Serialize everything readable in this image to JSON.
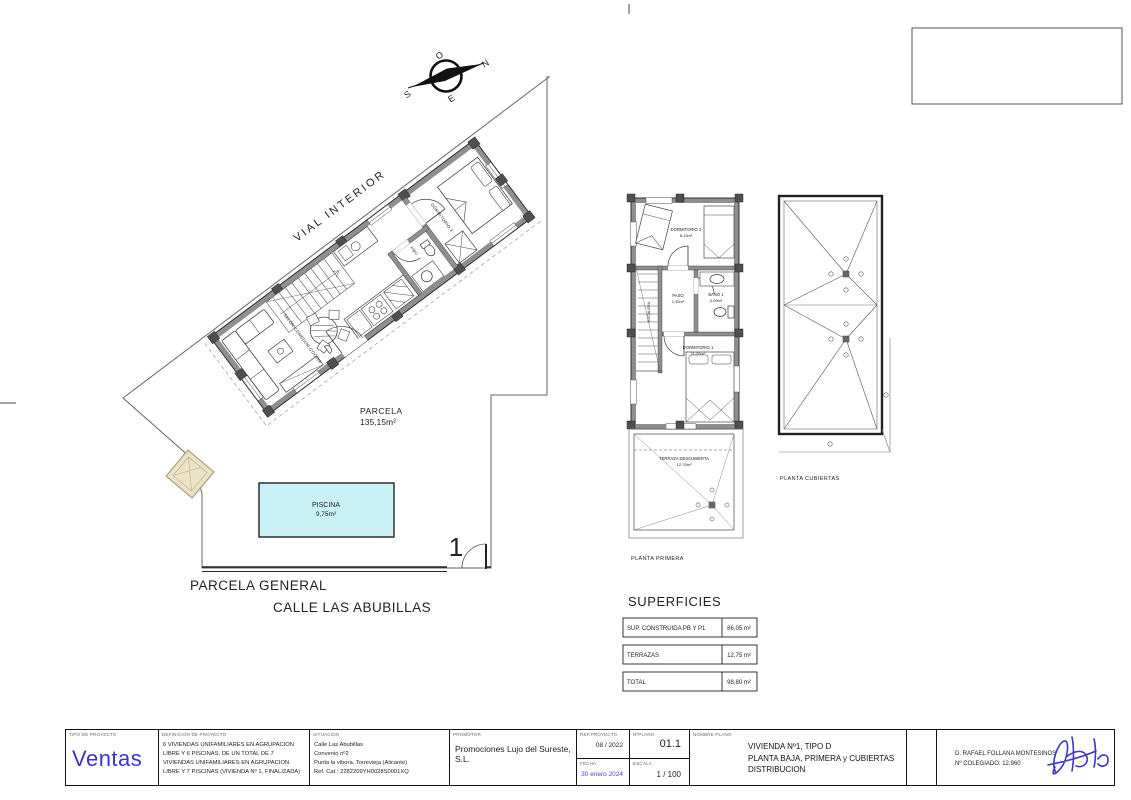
{
  "compass": {
    "n": "N",
    "s": "S",
    "e": "E",
    "o": "O"
  },
  "site": {
    "vial_interior": "VIAL INTERIOR",
    "parcela_label": "PARCELA",
    "parcela_area": "135,15m²",
    "piscina_label": "PISCINA",
    "piscina_area": "9,75m²",
    "parcela_general": "PARCELA GENERAL",
    "street": "CALLE LAS ABUBILLAS",
    "gate_number": "1"
  },
  "ground_floor": {
    "salon": "SALON-COMEDOR-COCINA",
    "dormitorio": "DORMITORIO 3",
    "aseo": "ASEO"
  },
  "first_floor": {
    "caption": "PLANTA PRIMERA",
    "dormitorio2": "DORMITORIO 2",
    "dormitorio2_area": "8,13m²",
    "escalera": "ESCALERA",
    "paso": "PASO",
    "paso_area": "1,92m²",
    "bano": "BAÑO 1",
    "bano_area": "3,09m²",
    "dormitorio1": "DORMITORIO 1",
    "dormitorio1_area": "11,20m²",
    "terraza": "TERRAZA DESCUBIERTA",
    "terraza_area": "12,75m²"
  },
  "roof": {
    "caption": "PLANTA CUBIERTAS"
  },
  "superficies": {
    "title": "SUPERFICIES",
    "rows": [
      {
        "label": "SUP. CONSTRUIDA PB Y P1",
        "value": "86,05 m²"
      },
      {
        "label": "TERRAZAS",
        "value": "12,75 m²"
      },
      {
        "label": "TOTAL",
        "value": "98,80 m²"
      }
    ]
  },
  "titleblock": {
    "tipo_label": "TIPO DE PROYECTO",
    "tipo_value": "Ventas",
    "definicion_label": "DEFINICION DE PROYECTO",
    "definicion_lines": [
      "6 VIVIENDAS UNIFAMILIARES EN AGRUPACION",
      "LIBRE Y 6 PISCINAS, DE UN TOTAL DE 7",
      "VIVIENDAS UNIFAMILIARES EN AGRUPACION",
      "LIBRE Y 7 PISCINAS (VIVIENDA Nº 1, FINALIZADA)"
    ],
    "situacion_label": "SITUACION",
    "situacion_lines": [
      "Calle Las Abubillas",
      "Convenio nº2",
      "Punta la vibora. Torrevieja (Alicante)",
      "Ref. Cat.: 2282209YH0028S0001XQ"
    ],
    "promotor_label": "PROMOTOR",
    "promotor_value": "Promociones Lujo del Sureste, S.L.",
    "ref_label": "REF.PROYECTO",
    "ref_value": "08 / 2022",
    "plano_label": "NºPLANO",
    "plano_value": "01.1",
    "fecha_label": "FECHA",
    "fecha_value": "30 enero 2024",
    "escala_label": "ESCALA",
    "escala_value": "1 / 100",
    "nombre_label": "NOMBRE PLANO",
    "nombre_lines": [
      "VIVIENDA Nº1, TIPO D",
      "PLANTA BAJA, PRIMERA y CUBIERTAS",
      "DISTRIBUCION"
    ],
    "arquitecto": "D. RAFAEL FOLLANA MONTESINOS",
    "colegiado": "Nº COLEGIADO: 12.960"
  },
  "colors": {
    "accent_blue": "#3a34cc",
    "date_blue": "#4b43cb",
    "pool_fill": "#c9f1f6",
    "wall_gray": "#8f8f8f",
    "pier_gray": "#4f4f4f",
    "tan_fill": "#ece2c4"
  }
}
